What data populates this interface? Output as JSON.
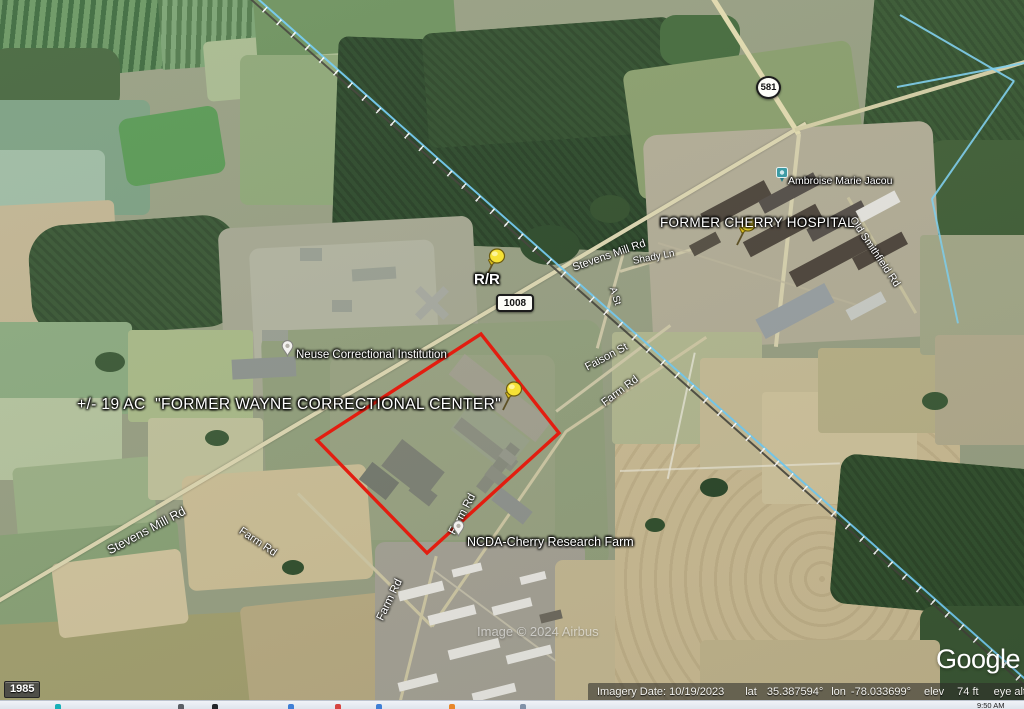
{
  "status_bar": {
    "imagery_date": "Imagery Date: 10/19/2023",
    "lat_label": "lat",
    "lat_value": "35.387594°",
    "lon_label": "lon",
    "lon_value": "-78.033699°",
    "elev_label": "elev",
    "elev_value": "74 ft",
    "eye_alt_label": "eye alt",
    "eye_alt_value": "5"
  },
  "time_slider": {
    "start_year": "1985"
  },
  "branding": {
    "logo": "Google",
    "imagery_credit": "Image © 2024 Airbus"
  },
  "annotations": {
    "site_label": "+/- 19 AC  \"FORMER WAYNE CORRECTIONAL CENTER\"",
    "railroad_crossing": "R/R",
    "hospital": "FORMER CHERRY HOSPITAL"
  },
  "places": {
    "neuse": "Neuse Correctional Institution",
    "ncda": "NCDA-Cherry Research Farm",
    "photo": "Ambroise Marie Jacou"
  },
  "road_labels": [
    "Stevens Mill Rd",
    "Stevens Mill Rd",
    "Farm Rd",
    "Farm Rd",
    "Farm Rd",
    "Farm Rd",
    "Faison St",
    "A St",
    "Shady Ln",
    "Old Smithfield Rd"
  ],
  "shields": {
    "route_1008": "1008",
    "route_581": "581"
  },
  "taskbar": {
    "clock": "9:50 AM"
  },
  "colors": {
    "parcel_outline": "#e31d10",
    "pushpin_yellow": "#f6e236",
    "railroad_overlay": "#72cbf2",
    "creek_blue": "#7fd2f2",
    "forest_green": "#2e4b2c"
  }
}
